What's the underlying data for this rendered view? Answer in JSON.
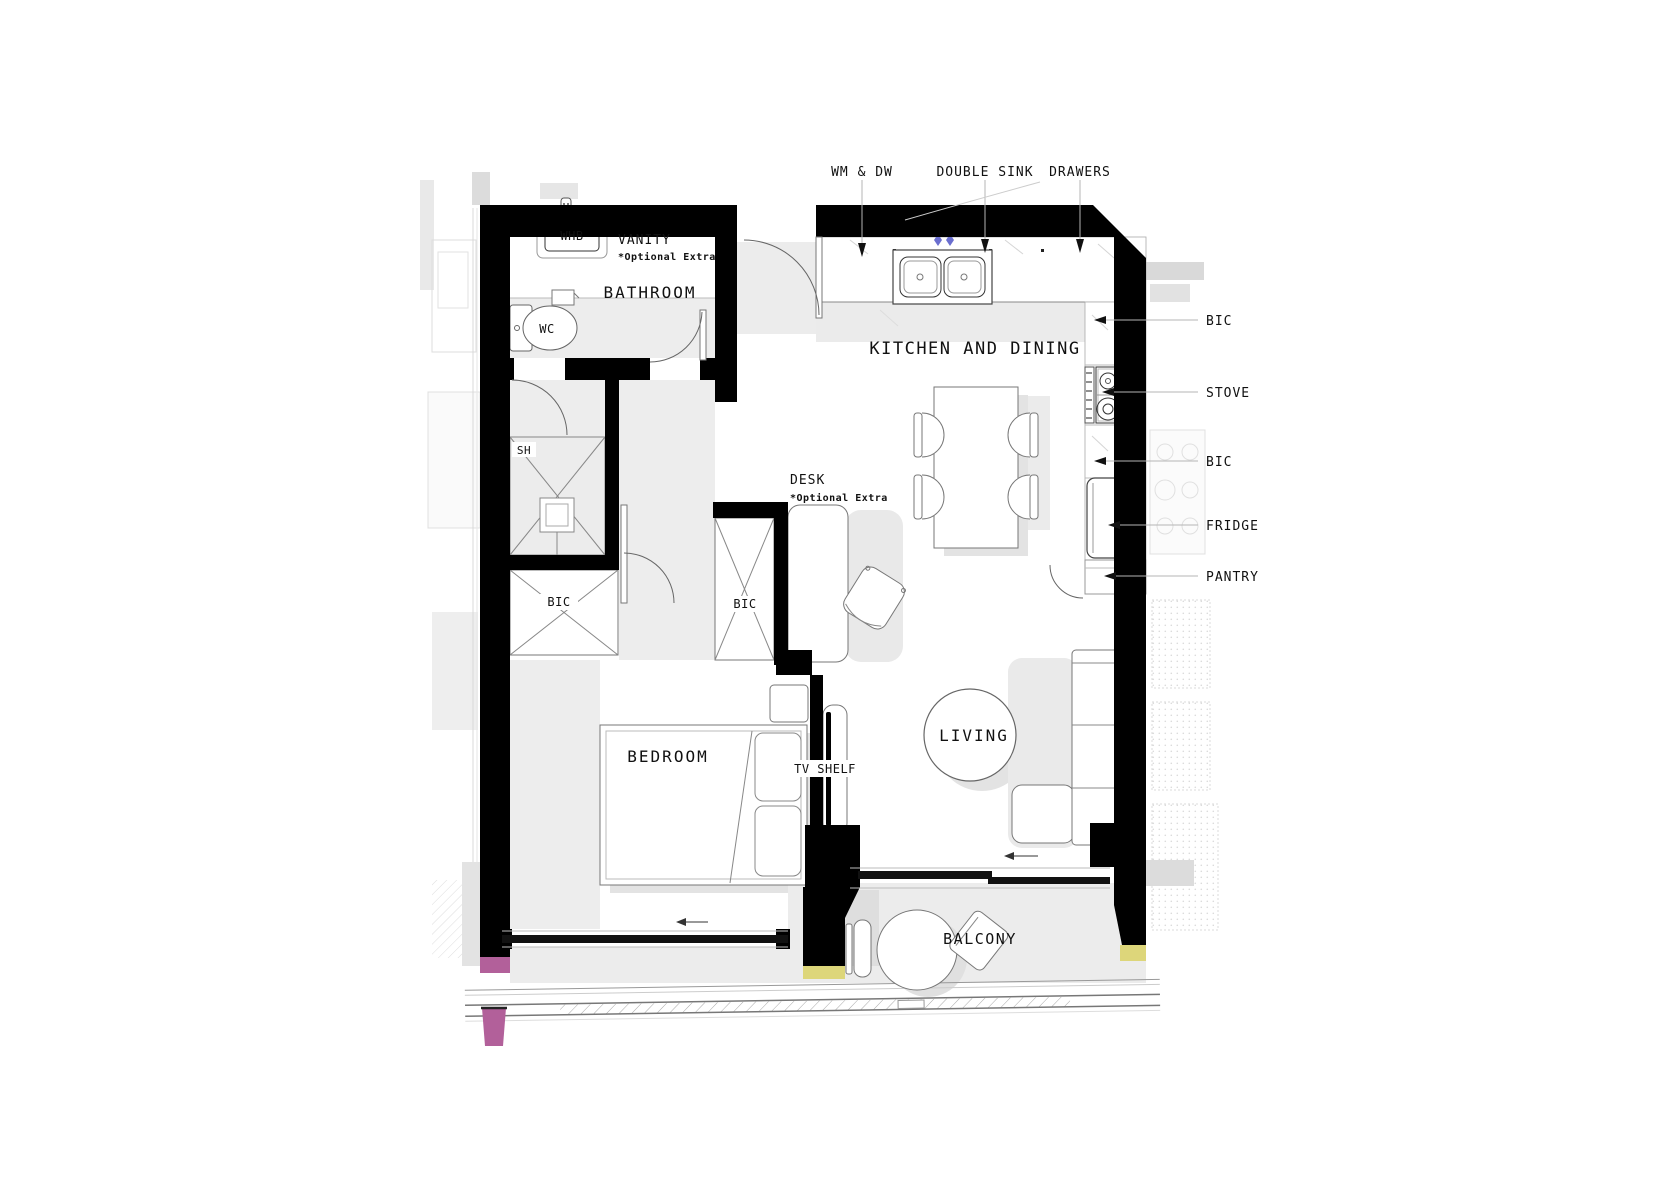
{
  "rooms": {
    "bathroom": "BATHROOM",
    "kitchen_dining": "KITCHEN AND DINING",
    "bedroom": "BEDROOM",
    "living": "LIVING",
    "balcony": "BALCONY"
  },
  "fixtures": {
    "whb": "WHB",
    "wc": "WC",
    "shower": "SH",
    "bic_closet": "BIC",
    "bic_wardrobe": "BIC",
    "tv_shelf": "TV SHELF"
  },
  "callouts": {
    "wm_dw": "WM & DW",
    "double_sink": "DOUBLE SINK",
    "drawers": "DRAWERS",
    "bic_top": "BIC",
    "stove": "STOVE",
    "bic_mid": "BIC",
    "fridge": "FRIDGE",
    "pantry": "PANTRY",
    "vanity": "VANITY",
    "vanity_note": "*Optional Extra",
    "desk": "DESK",
    "desk_note": "*Optional Extra"
  },
  "colors": {
    "wall": "#000000",
    "accent_pink": "#b2609a",
    "accent_yellow": "#ddd67a",
    "accent_blue": "#6a6ecf",
    "shadow": "#e8e8e8"
  }
}
